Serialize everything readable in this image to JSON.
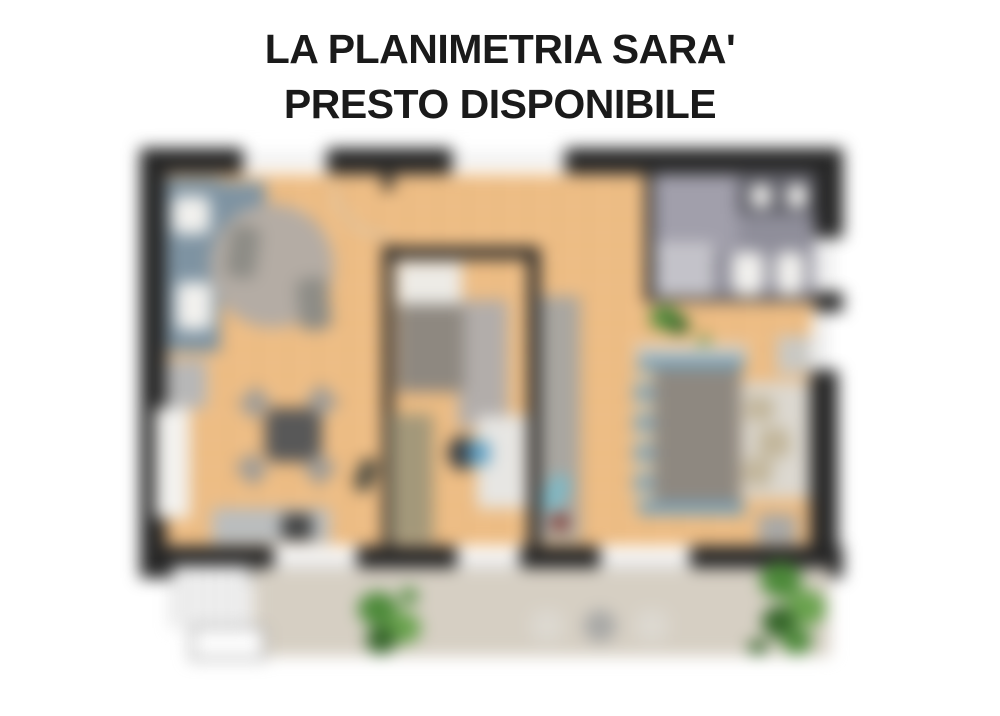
{
  "title": {
    "line1": "LA PLANIMETRIA SARA'",
    "line2": "PRESTO DISPONIBILE"
  },
  "floorplan": {
    "description": "blurred apartment floor plan placeholder",
    "rooms": [
      "living-kitchen",
      "middle-bedroom",
      "bathroom",
      "master-bedroom",
      "terrace"
    ]
  },
  "palette": {
    "titleColor": "#1a1a1a",
    "wall": "#262626",
    "wood": "#eebd84",
    "kitchen": "#7e93a2",
    "fixture": "#f2f1ee",
    "cabinet": "#b7b7b7",
    "niche": "#f3f2ef",
    "rug": "#b4aca4",
    "rugDark": "#8d8c86",
    "tableDark": "#585858",
    "chair": "#a09c96",
    "sideboard": "#babdbe",
    "dark": "#3f4040",
    "bathFloor": "#8f8e9a",
    "bathTile": "#a19fab",
    "vanity": "#5d5d66",
    "shower": "#c3c2c9",
    "pillow": "#edebe6",
    "bedGray": "#8e8880",
    "wardrobe": "#a3987a",
    "rug2": "#b2adaa",
    "desk": "#e7e6e3",
    "chairDark": "#343a40",
    "teal": "#5fa0c4",
    "closet": "#a9a6a0",
    "tealLight": "#7fb8c4",
    "red": "#7b241c",
    "headboard": "#d7d1c6",
    "blue": "#7ba0b5",
    "stripeTan": "#cfc0a5",
    "nookRug": "#dcd8d0",
    "cushion": "#c2b69b",
    "dresser": "#c9c8c3",
    "tv": "#a8a8a6",
    "terrace": "#d6cfc3",
    "stairLine": "#9a9a9a",
    "green": "#4d8a3a",
    "greenDark": "#35652a",
    "greenLight": "#6aa34e",
    "arc": "#cfc9bc",
    "windowLine": "#8f8f8f",
    "olive": "#4a4a40"
  }
}
